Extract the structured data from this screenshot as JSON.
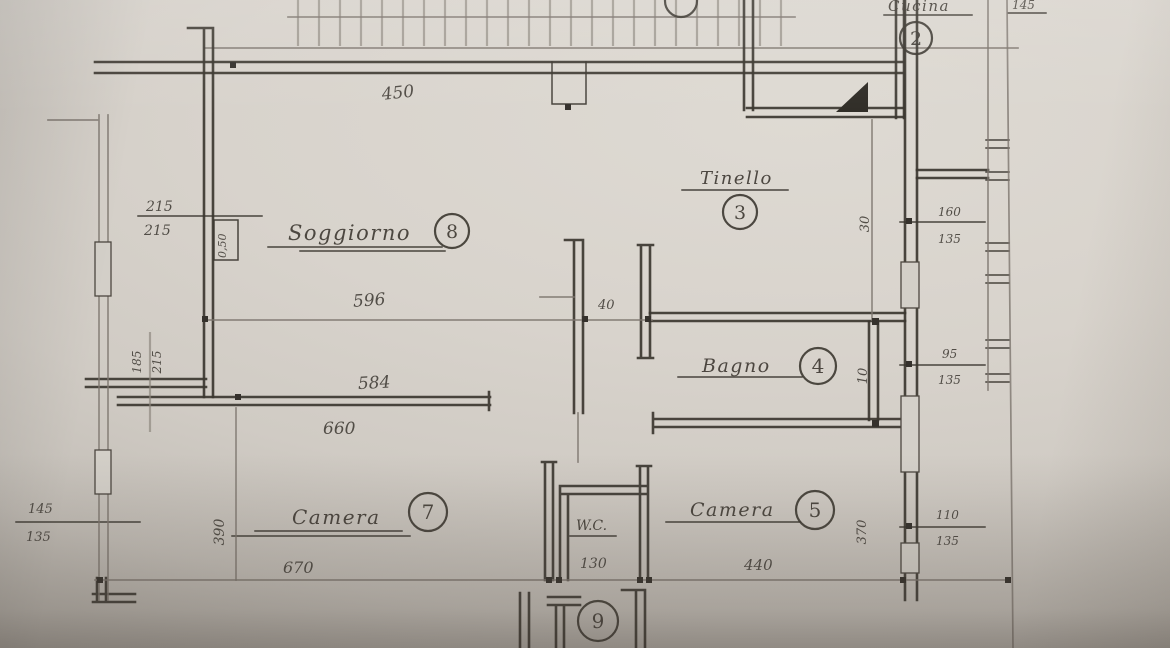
{
  "palette": {
    "paper": "#d6d1c9",
    "ink": "#3a352e",
    "pencil": "#7d766e"
  },
  "rooms": {
    "r1": {
      "number": "1",
      "name": ""
    },
    "r2": {
      "number": "2",
      "name": "Cucina"
    },
    "r3": {
      "number": "3",
      "name": "Tinello"
    },
    "r4": {
      "number": "4",
      "name": "Bagno"
    },
    "r5": {
      "number": "5",
      "name": "Camera"
    },
    "r7": {
      "number": "7",
      "name": "Camera"
    },
    "r8": {
      "number": "8",
      "name": "Soggiorno"
    },
    "r9": {
      "number": "9",
      "name": ""
    },
    "wc": {
      "name": "W.C."
    }
  },
  "dims": {
    "balcony_width": "450",
    "top_right": "145",
    "left_top_upper": "215",
    "left_top_lower": "215",
    "pillar_rot": "0,50",
    "soggiorno_width": "596",
    "wall_gap": "40",
    "camera_inner_width": "584",
    "camera_outer_width": "660",
    "mid_rot_a": "185",
    "mid_rot_b": "215",
    "camera7_depth_rot": "390",
    "left_bottom_upper": "145",
    "left_bottom_lower": "135",
    "camera7_width": "670",
    "wc_width": "130",
    "camera5_width": "440",
    "camera5_depth_rot": "370",
    "tinello_wall_rot": "30",
    "bagno_wall_rot": "10",
    "right_top_upper": "160",
    "right_top_lower": "135",
    "right_mid_upper": "95",
    "right_mid_lower": "135",
    "right_bottom_upper": "110",
    "right_bottom_lower": "135"
  }
}
